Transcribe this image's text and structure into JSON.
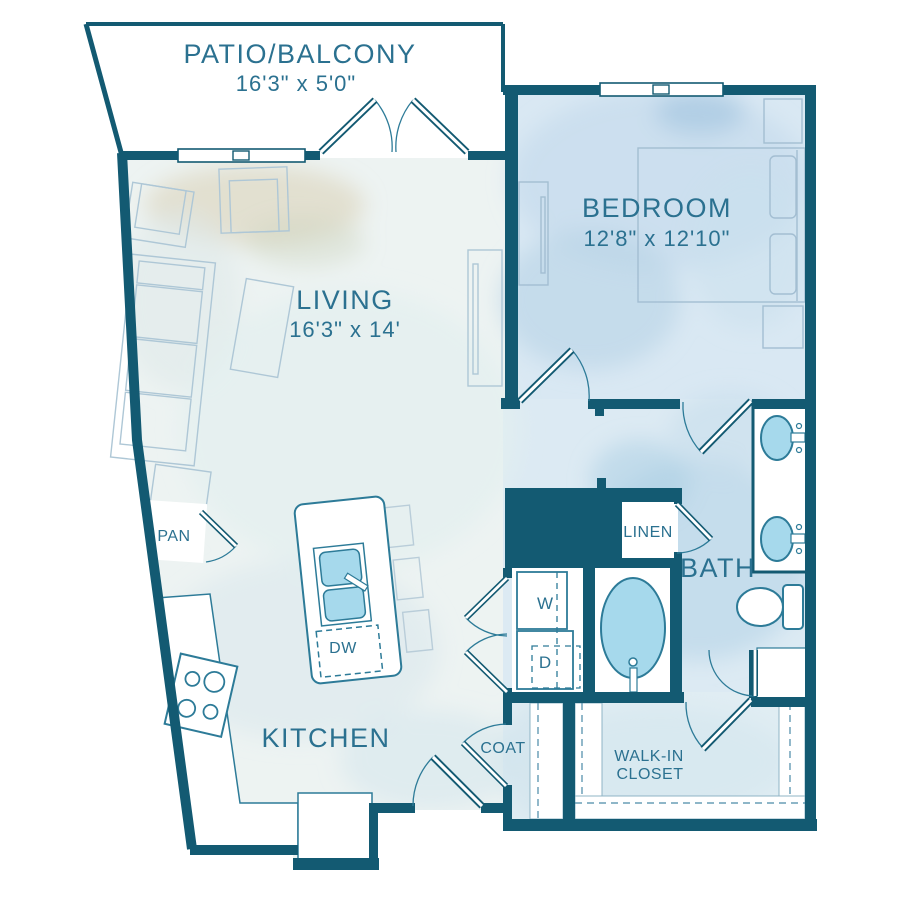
{
  "rooms": {
    "patio": {
      "label": "PATIO/BALCONY",
      "dims": "16'3\" x 5'0\""
    },
    "living": {
      "label": "LIVING",
      "dims": "16'3\" x 14'"
    },
    "bedroom": {
      "label": "BEDROOM",
      "dims": "12'8\" x 12'10\""
    },
    "kitchen": {
      "label": "KITCHEN"
    },
    "bath": {
      "label": "BATH"
    },
    "walk_in_closet": {
      "line1": "WALK-IN",
      "line2": "CLOSET"
    },
    "coat": {
      "label": "COAT"
    },
    "pantry": {
      "label": "PAN"
    },
    "linen": {
      "label": "LINEN"
    }
  },
  "appliances": {
    "washer": "W",
    "dryer": "D",
    "dishwasher": "DW"
  },
  "colors": {
    "wall": "#135a72",
    "label_text": "#2b7190",
    "fixture_outline": "#2d7b98",
    "water_fill": "#a6d9ec",
    "furniture_outline": "#aec7d6"
  }
}
